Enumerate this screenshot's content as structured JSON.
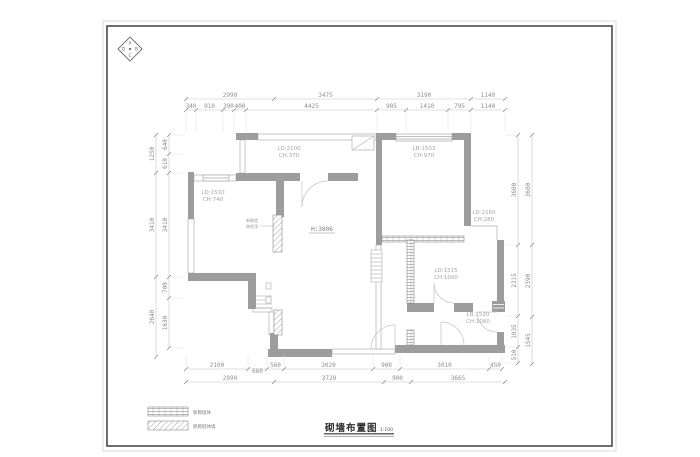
{
  "sheet": {
    "title": "砌墙布置图",
    "scale": "1:100",
    "compass_letters": [
      "A",
      "B",
      "C",
      "D"
    ],
    "legend": [
      {
        "swatch": "brick-hatch",
        "label": "新砌墙体"
      },
      {
        "swatch": "diagonal-hatch",
        "label": "新砌轻体墙"
      }
    ]
  },
  "colors": {
    "wall_gray": "#9d9d9d",
    "thin_line": "#b0b0b0",
    "dim_text": "#8f8f8f",
    "border": "#4a4a4a"
  },
  "dims": {
    "horizontal": [
      {
        "id": "top-outer",
        "y": 99,
        "ticks": [
          186,
          274,
          377,
          471,
          505
        ],
        "labels": [
          "2990",
          "3475",
          "3190",
          "1140"
        ]
      },
      {
        "id": "top-inner",
        "y": 110,
        "ticks": [
          186,
          196,
          223,
          234,
          246,
          377,
          406,
          448,
          471,
          505
        ],
        "labels": [
          "340",
          "910",
          "390",
          "400",
          "4425",
          "985",
          "1410",
          "795",
          "1140"
        ],
        "ext": [
          3,
          22
        ]
      },
      {
        "id": "bottom-inner",
        "y": 369,
        "ticks": [
          186,
          248,
          267,
          284,
          373,
          400,
          489,
          502
        ],
        "labels": [
          "2100",
          "660",
          "560",
          "3020",
          "900",
          "3010",
          "450"
        ],
        "ext": [
          -14,
          -3
        ],
        "offsets": [
          0,
          6,
          0,
          0,
          0,
          0,
          0
        ]
      },
      {
        "id": "bottom-outer",
        "y": 382,
        "ticks": [
          186,
          274,
          384,
          411,
          505
        ],
        "labels": [
          "2990",
          "3720",
          "900",
          "3665"
        ]
      }
    ],
    "vertical": [
      {
        "id": "left-outer",
        "x": 156,
        "ticks": [
          135,
          173,
          277,
          357
        ],
        "labels": [
          "1250",
          "3410",
          "2640"
        ]
      },
      {
        "id": "left-inner",
        "x": 169,
        "ticks": [
          135,
          154,
          173,
          277,
          298,
          348
        ],
        "labels": [
          "640",
          "610",
          "3410",
          "700",
          "1630"
        ],
        "ext": [
          3,
          16
        ]
      },
      {
        "id": "right-inner",
        "x": 518,
        "ticks": [
          135,
          245,
          316,
          347,
          363
        ],
        "labels": [
          "3600",
          "2315",
          "1035",
          "510"
        ],
        "ext": [
          -12,
          -3
        ]
      },
      {
        "id": "right-outer",
        "x": 532,
        "ticks": [
          135,
          245,
          317,
          364
        ],
        "labels": [
          "3600",
          "2390",
          "1545"
        ]
      }
    ]
  },
  "rooms": [
    {
      "x": 289,
      "y": 150,
      "lines": [
        "LD:2100",
        "CH:370"
      ]
    },
    {
      "x": 424,
      "y": 150,
      "lines": [
        "LB:1503",
        "CH:970"
      ]
    },
    {
      "x": 213,
      "y": 194,
      "lines": [
        "LD:1510",
        "CH:740"
      ]
    },
    {
      "x": 484,
      "y": 214,
      "lines": [
        "LD:2160",
        "CH:280"
      ]
    },
    {
      "x": 446,
      "y": 272,
      "lines": [
        "LD:1515",
        "CH:1000"
      ]
    },
    {
      "x": 478,
      "y": 316,
      "lines": [
        "LB:1520",
        "CH:1060"
      ]
    }
  ],
  "annotations": {
    "height": {
      "x": 322,
      "y": 231,
      "text": "H:3806"
    },
    "leader": {
      "x": 258,
      "y": 222,
      "lines": [
        "新砌墙",
        "做到顶"
      ],
      "line": [
        260,
        226,
        276,
        226
      ]
    }
  }
}
